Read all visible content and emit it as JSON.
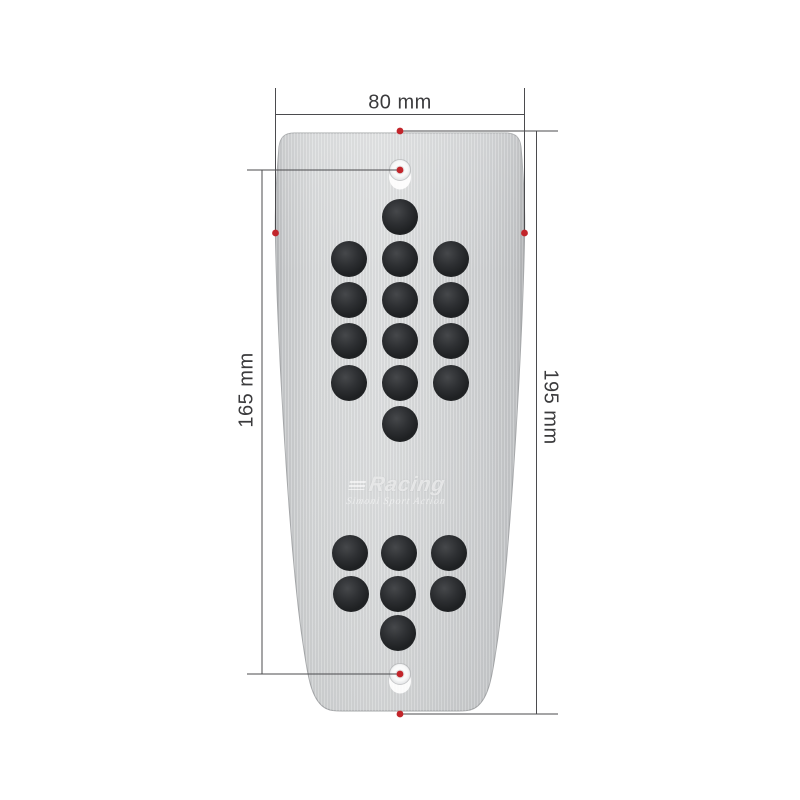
{
  "figure": {
    "title": "aluminum pedal plate with dimensions",
    "background_color": "#ffffff",
    "product": {
      "plate_color_light": "#dddfe0",
      "plate_color_mid": "#d3d5d7",
      "plate_color_dark": "#b2b4b6",
      "pin_color": "#232527",
      "logo_text": "Racing",
      "logo_subtext": "Simoni Sport Action"
    },
    "dimensions": {
      "width_label": "80 mm",
      "holes_distance_label": "165 mm",
      "length_label": "195 mm",
      "annotation_color": "#c2252b",
      "line_color": "#4b4b4e",
      "label_color": "#3b3b3d"
    },
    "pins": {
      "radius": 18,
      "upper": [
        [
          400,
          217
        ],
        [
          349,
          259
        ],
        [
          400,
          259
        ],
        [
          451,
          259
        ],
        [
          349,
          300
        ],
        [
          400,
          300
        ],
        [
          451,
          300
        ],
        [
          349,
          341
        ],
        [
          400,
          341
        ],
        [
          451,
          341
        ],
        [
          349,
          383
        ],
        [
          400,
          383
        ],
        [
          451,
          383
        ],
        [
          400,
          424
        ]
      ],
      "lower": [
        [
          350,
          553
        ],
        [
          399,
          553
        ],
        [
          449,
          553
        ],
        [
          351,
          594
        ],
        [
          398,
          594
        ],
        [
          448,
          594
        ],
        [
          398,
          633
        ]
      ]
    },
    "screw_holes": [
      [
        400,
        170
      ],
      [
        400,
        674
      ]
    ],
    "red_dots": [
      [
        400,
        131
      ],
      [
        400,
        170
      ],
      [
        275.5,
        233
      ],
      [
        524.5,
        233
      ],
      [
        400,
        674
      ],
      [
        400,
        714
      ]
    ]
  }
}
